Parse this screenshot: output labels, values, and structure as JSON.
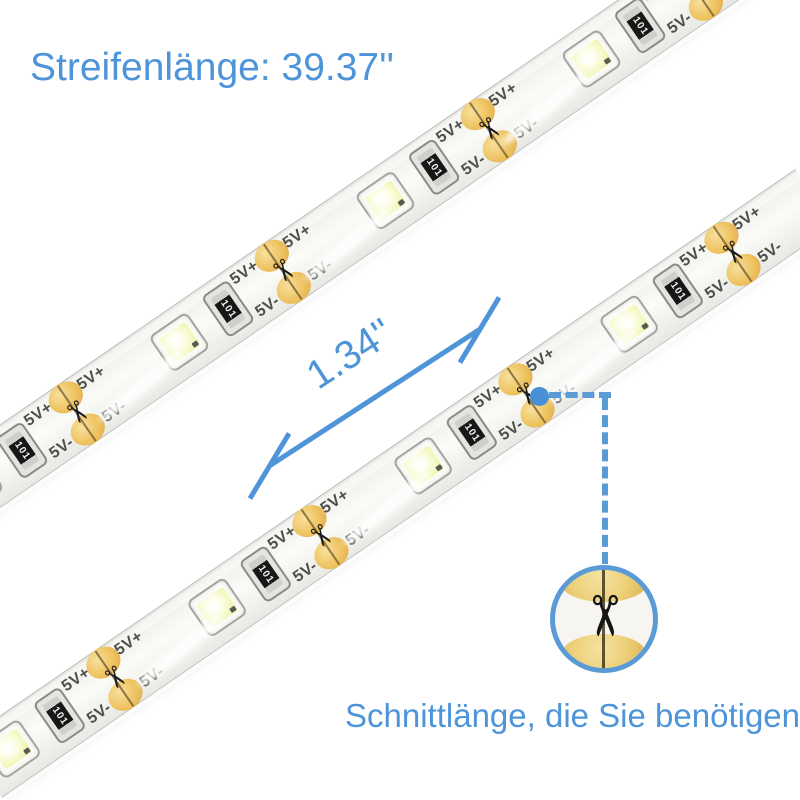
{
  "title": "Streifenlänge: 39.37''",
  "measurement": {
    "label": "1.34''"
  },
  "callout": {
    "caption": "Schnittlänge, die Sie benötigen"
  },
  "strip_print": {
    "positive": "5V+",
    "negative": "5V-",
    "resistor_code": "101"
  },
  "icons": {
    "scissors": "✂"
  },
  "colors": {
    "annotation_blue": "#4e94d8",
    "callout_blue": "#5b9bd5",
    "dot_blue": "#4790d6",
    "pad_gold": "#eec25f",
    "led_glow": "#f3f8bd"
  },
  "strips": [
    {
      "name": "strip-top",
      "anchor_x": -40,
      "anchor_y": 492.8,
      "angle_deg": -34.5,
      "length": 930,
      "cuts": [
        141,
        391,
        641,
        891
      ],
      "leds": [
        16,
        266,
        516,
        766
      ],
      "resistors": [
        75,
        325,
        575,
        825
      ],
      "gloss": [
        210,
        460,
        700
      ]
    },
    {
      "name": "strip-bottom",
      "anchor_x": -18,
      "anchor_y": 768.6,
      "angle_deg": -34.5,
      "length": 1010,
      "cuts": [
        160,
        410,
        660,
        910
      ],
      "leds": [
        35,
        285,
        535,
        785
      ],
      "resistors": [
        94,
        344,
        594,
        844
      ],
      "gloss": [
        230,
        480,
        730
      ]
    }
  ]
}
